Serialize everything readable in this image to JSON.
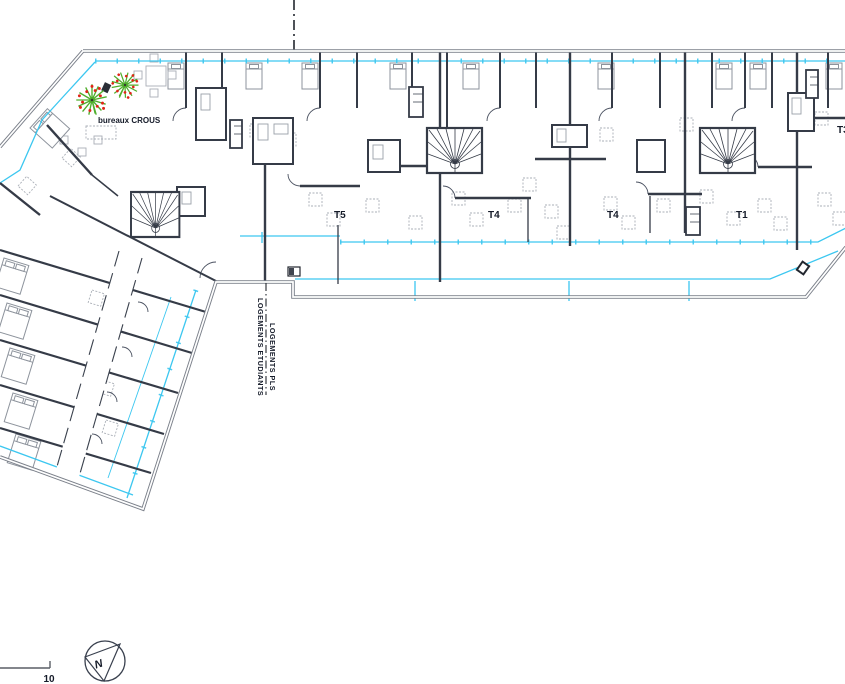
{
  "drawing": {
    "annotations": {
      "terrace_label": "bureaux CROUS",
      "units": {
        "t5": "T5",
        "t4_left": "T4",
        "t4_right": "T4",
        "t1": "T1",
        "t3": "T3"
      },
      "tenure_split": {
        "upper": "LOGEMENTS PLS",
        "lower": "LOGEMENTS ETUDIANTS"
      },
      "scale_value": "10",
      "north_letter": "N"
    },
    "colors": {
      "glazing": "#3cc7f0",
      "interior_wall": "#353b47",
      "outer_wall": "#7b808a",
      "tree_foliage": "#4fae2c",
      "tree_berries": "#e02517",
      "furniture": "#9aa0a8",
      "ink": "#151b29"
    }
  }
}
